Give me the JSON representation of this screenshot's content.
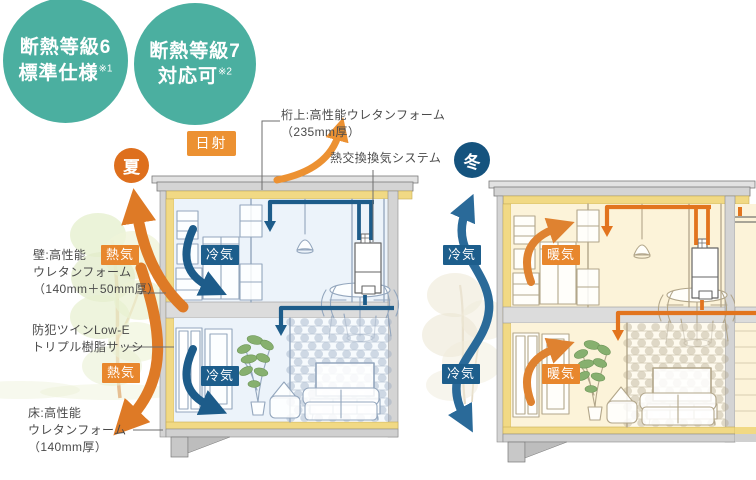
{
  "grade_badges": {
    "grade6": {
      "line1": "断熱等級6",
      "line2": "標準仕様",
      "note": "※1"
    },
    "grade7": {
      "line1": "断熱等級7",
      "line2": "対応可",
      "note": "※2"
    }
  },
  "seasons": {
    "summer": "夏",
    "winter": "冬"
  },
  "flows": {
    "solar": "日射",
    "hot": "熱気",
    "cool": "冷気",
    "warm": "暖気"
  },
  "annotations": {
    "girder": {
      "line1": "桁上:高性能ウレタンフォーム",
      "line2": "（235mm厚）"
    },
    "ventilation": {
      "line1": "熱交換換気システム"
    },
    "wall": {
      "line1": "壁:高性能",
      "line2": "ウレタンフォーム",
      "line3": "（140mm＋50mm厚）"
    },
    "window": {
      "line1": "防犯ツインLow-E",
      "line2": "トリプル樹脂サッシ"
    },
    "floor": {
      "line1": "床:高性能",
      "line2": "ウレタンフォーム",
      "line3": "（140mm厚）"
    }
  },
  "colors": {
    "teal": "#4BAFA0",
    "summer_orange": "#DE6F1D",
    "winter_blue": "#15537E",
    "solar_orange": "#EC9132",
    "hot_orange": "#E8872D",
    "cool_blue": "#1D5E8C",
    "duct_blue": "#1D5C8A",
    "duct_orange": "#E2741E",
    "insulation_yellow": "#F1D984"
  }
}
